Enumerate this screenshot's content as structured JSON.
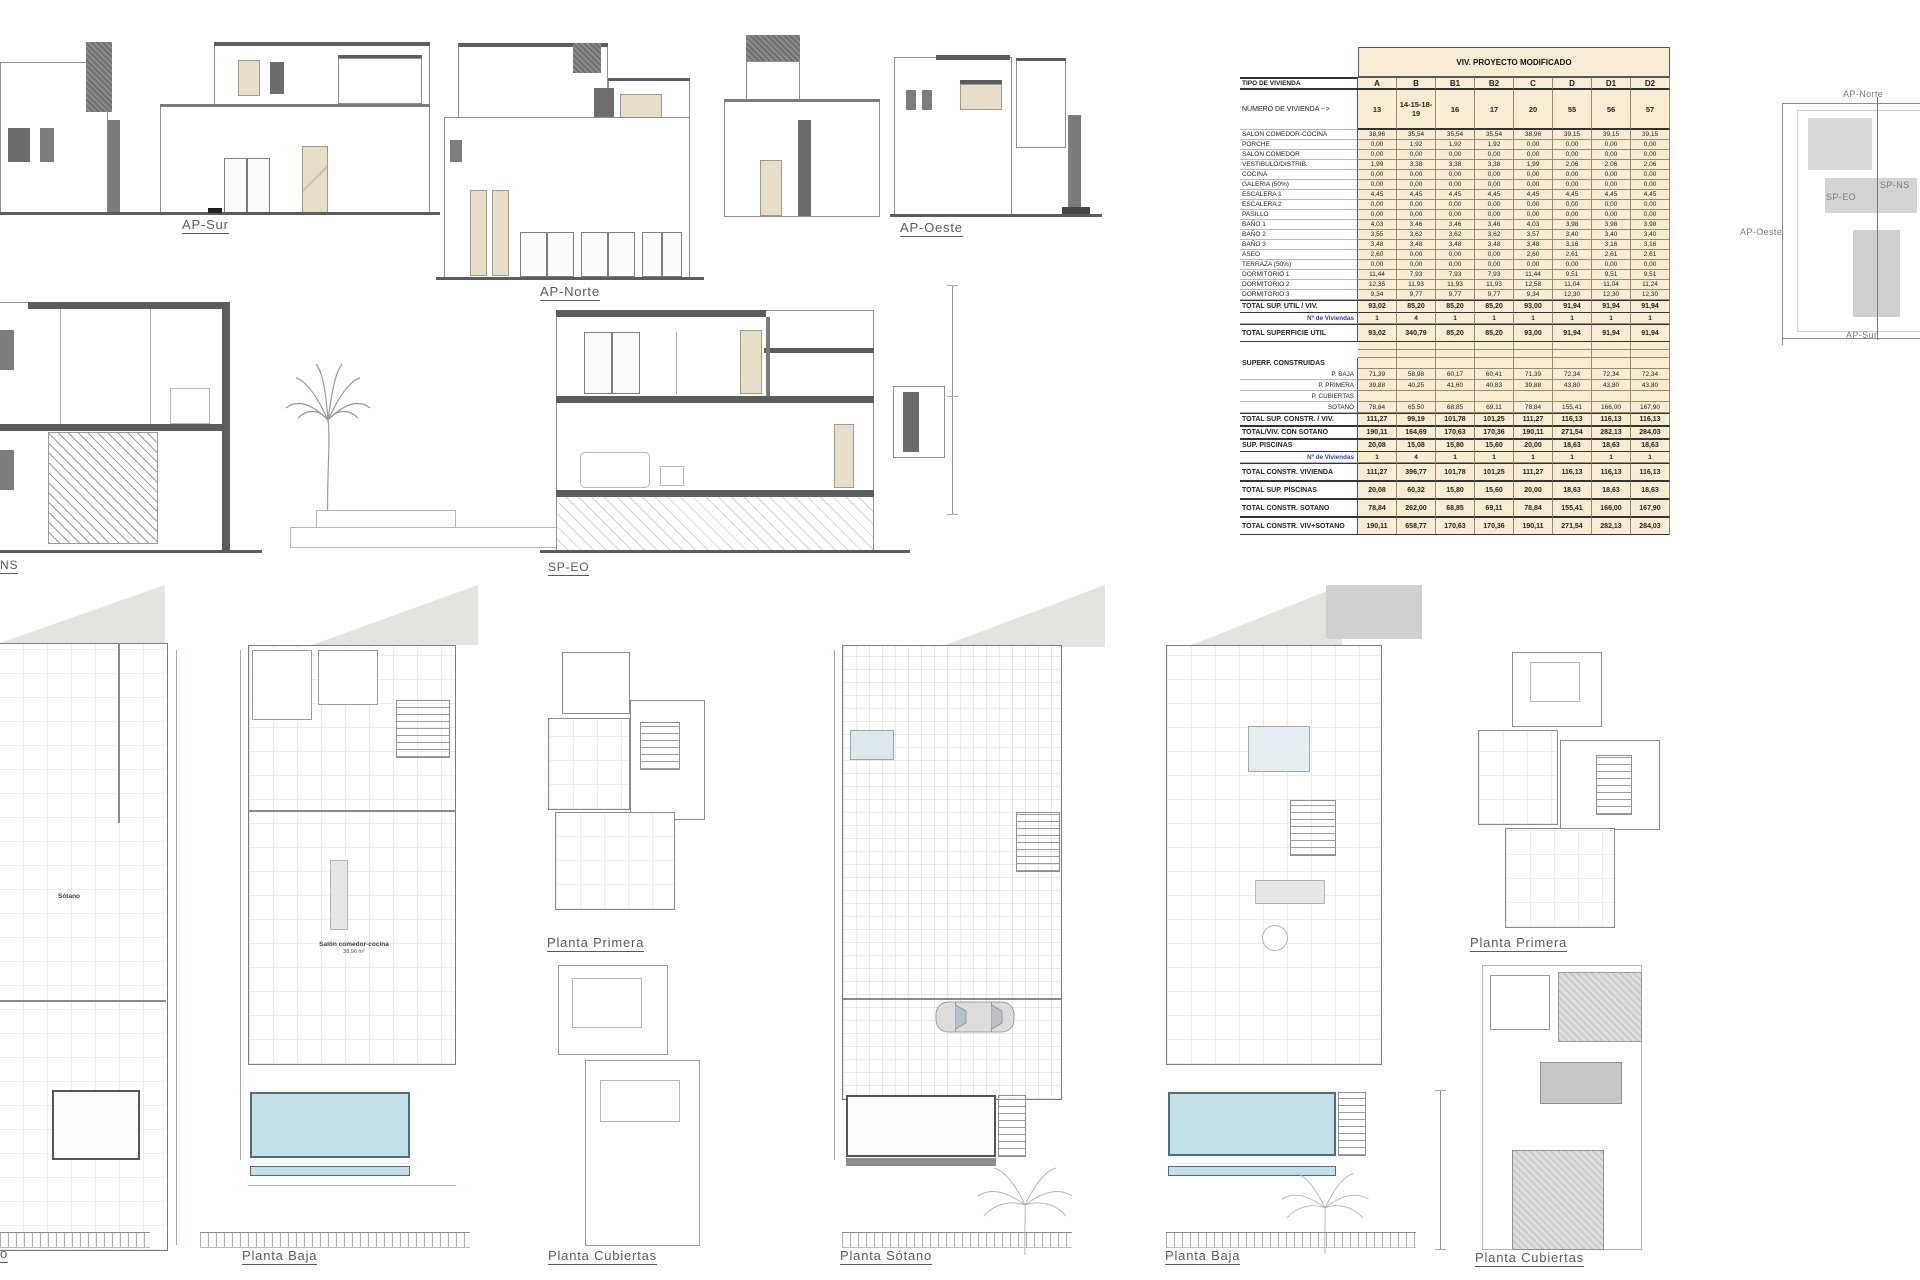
{
  "labels": {
    "ap_sur": "AP-Sur",
    "ap_norte": "AP-Norte",
    "ap_oeste": "AP-Oeste",
    "sp_eo": "SP-EO",
    "sp_ns_truncated": "NS"
  },
  "key_plan": {
    "north": "AP-Norte",
    "west": "AP-Oeste",
    "south": "AP-Sur",
    "sp_ns": "SP-NS",
    "sp_eo": "SP-EO"
  },
  "plans": {
    "col1": {
      "label_truncated": "o",
      "room_label": "Sótano"
    },
    "col2": {
      "label": "Planta Baja",
      "room_label": "Salón comedor-cocina",
      "room_area": "38,96 m²"
    },
    "col3_top": {
      "label": "Planta Primera"
    },
    "col3_bottom": {
      "label": "Planta Cubiertas"
    },
    "col4": {
      "label": "Planta Sótano"
    },
    "col5": {
      "label": "Planta Baja"
    },
    "col6_top": {
      "label": "Planta Primera"
    },
    "col6_bottom": {
      "label": "Planta Cubiertas"
    }
  },
  "table": {
    "title": "VIV. PROYECTO MODIFICADO",
    "tipo_label": "TIPO DE VIVIENDA",
    "numero_label": "NUMERO DE VIVIENDA -->",
    "types": [
      "A",
      "B",
      "B1",
      "B2",
      "C",
      "D",
      "D1",
      "D2"
    ],
    "numeros": [
      "13",
      "14-15-18-19",
      "16",
      "17",
      "20",
      "55",
      "56",
      "57"
    ],
    "rows": [
      {
        "s": "n",
        "label": "SALON COMEDOR-COCINA",
        "v": [
          "38,96",
          "35,54",
          "35,54",
          "35,54",
          "38,96",
          "39,15",
          "39,15",
          "39,15"
        ]
      },
      {
        "s": "n",
        "label": "PORCHE",
        "v": [
          "0,00",
          "1,92",
          "1,92",
          "1,92",
          "0,00",
          "0,00",
          "0,00",
          "0,00"
        ]
      },
      {
        "s": "n",
        "label": "SALON COMEDOR",
        "v": [
          "0,00",
          "0,00",
          "0,00",
          "0,00",
          "0,00",
          "0,00",
          "0,00",
          "0,00"
        ]
      },
      {
        "s": "n",
        "label": "VESTIBULO/DISTRIB.",
        "v": [
          "1,99",
          "3,38",
          "3,38",
          "3,38",
          "1,99",
          "2,06",
          "2,06",
          "2,06"
        ]
      },
      {
        "s": "n",
        "label": "COCINA",
        "v": [
          "0,00",
          "0,00",
          "0,00",
          "0,00",
          "0,00",
          "0,00",
          "0,00",
          "0,00"
        ]
      },
      {
        "s": "n",
        "label": "GALERIA (50%)",
        "v": [
          "0,00",
          "0,00",
          "0,00",
          "0,00",
          "0,00",
          "0,00",
          "0,00",
          "0,00"
        ]
      },
      {
        "s": "n",
        "label": "ESCALERA 1",
        "v": [
          "4,45",
          "4,45",
          "4,45",
          "4,45",
          "4,45",
          "4,45",
          "4,45",
          "4,45"
        ]
      },
      {
        "s": "n",
        "label": "ESCALERA 2",
        "v": [
          "0,00",
          "0,00",
          "0,00",
          "0,00",
          "0,00",
          "0,00",
          "0,00",
          "0,00"
        ]
      },
      {
        "s": "n",
        "label": "PASILLO",
        "v": [
          "0,00",
          "0,00",
          "0,00",
          "0,00",
          "0,00",
          "0,00",
          "0,00",
          "0,00"
        ]
      },
      {
        "s": "n",
        "label": "BAÑO 1",
        "v": [
          "4,03",
          "3,46",
          "3,46",
          "3,46",
          "4,03",
          "3,98",
          "3,98",
          "3,98"
        ]
      },
      {
        "s": "n",
        "label": "BAÑO 2",
        "v": [
          "3,55",
          "3,62",
          "3,62",
          "3,62",
          "3,57",
          "3,40",
          "3,40",
          "3,40"
        ]
      },
      {
        "s": "n",
        "label": "BAÑO 3",
        "v": [
          "3,48",
          "3,48",
          "3,48",
          "3,48",
          "3,48",
          "3,16",
          "3,16",
          "3,16"
        ]
      },
      {
        "s": "n",
        "label": "ASEO",
        "v": [
          "2,60",
          "0,00",
          "0,00",
          "0,00",
          "2,60",
          "2,61",
          "2,61",
          "2,61"
        ]
      },
      {
        "s": "n",
        "label": "TERRAZA (50%)",
        "v": [
          "0,00",
          "0,00",
          "0,00",
          "0,00",
          "0,00",
          "0,00",
          "0,00",
          "0,00"
        ]
      },
      {
        "s": "n",
        "label": "DORMITORIO 1",
        "v": [
          "11,44",
          "7,93",
          "7,93",
          "7,93",
          "11,44",
          "9,51",
          "9,51",
          "9,51"
        ]
      },
      {
        "s": "n",
        "label": "DORMITORIO 2",
        "v": [
          "12,35",
          "11,93",
          "11,93",
          "11,93",
          "12,58",
          "11,04",
          "11,04",
          "11,24"
        ]
      },
      {
        "s": "n",
        "label": "DORMITORIO 3",
        "v": [
          "9,34",
          "9,77",
          "9,77",
          "9,77",
          "9,34",
          "12,30",
          "12,30",
          "12,30"
        ]
      },
      {
        "s": "b",
        "label": "TOTAL SUP. UTIL / VIV.",
        "v": [
          "93,02",
          "85,20",
          "85,20",
          "85,20",
          "93,00",
          "91,94",
          "91,94",
          "91,94"
        ]
      },
      {
        "s": "u",
        "label": "Nº de Viviendas",
        "v": [
          "1",
          "4",
          "1",
          "1",
          "1",
          "1",
          "1",
          "1"
        ]
      },
      {
        "s": "bt",
        "label": "TOTAL SUPERFICIE UTIL",
        "v": [
          "93,02",
          "340,79",
          "85,20",
          "85,20",
          "93,00",
          "91,94",
          "91,94",
          "91,94"
        ]
      },
      {
        "s": "e",
        "label": "",
        "v": [
          "",
          "",
          "",
          "",
          "",
          "",
          "",
          ""
        ]
      },
      {
        "s": "e",
        "label": "",
        "v": [
          "",
          "",
          "",
          "",
          "",
          "",
          "",
          ""
        ]
      },
      {
        "s": "sec",
        "label": "SUPERF. CONSTRUIDAS",
        "v": [
          "",
          "",
          "",
          "",
          "",
          "",
          "",
          ""
        ]
      },
      {
        "s": "r",
        "label": "P. BAJA",
        "v": [
          "71,39",
          "58,98",
          "60,17",
          "60,41",
          "71,39",
          "72,34",
          "72,34",
          "72,34"
        ]
      },
      {
        "s": "r",
        "label": "P. PRIMERA",
        "v": [
          "39,88",
          "40,25",
          "41,60",
          "40,83",
          "39,88",
          "43,80",
          "43,80",
          "43,80"
        ]
      },
      {
        "s": "r",
        "label": "P. CUBIERTAS",
        "v": [
          "",
          "",
          "",
          "",
          "",
          "",
          "",
          ""
        ]
      },
      {
        "s": "r",
        "label": "SOTANO",
        "v": [
          "78,84",
          "65,50",
          "68,85",
          "69,11",
          "78,84",
          "155,41",
          "166,00",
          "167,90"
        ]
      },
      {
        "s": "b",
        "label": "TOTAL SUP. CONSTR. / VIV.",
        "v": [
          "111,27",
          "99,19",
          "101,78",
          "101,25",
          "111,27",
          "116,13",
          "116,13",
          "116,13"
        ]
      },
      {
        "s": "b",
        "label": "TOTAL/VIV. CON SOTANO",
        "v": [
          "190,11",
          "164,69",
          "170,63",
          "170,36",
          "190,11",
          "271,54",
          "282,13",
          "284,03"
        ]
      },
      {
        "s": "b",
        "label": "SUP. PISCINAS",
        "v": [
          "20,08",
          "15,08",
          "15,80",
          "15,60",
          "20,00",
          "18,63",
          "18,63",
          "18,63"
        ]
      },
      {
        "s": "u",
        "label": "Nº de Viviendas",
        "v": [
          "1",
          "4",
          "1",
          "1",
          "1",
          "1",
          "1",
          "1"
        ]
      },
      {
        "s": "bt",
        "label": "TOTAL CONSTR. VIVIENDA",
        "v": [
          "111,27",
          "396,77",
          "101,78",
          "101,25",
          "111,27",
          "116,13",
          "116,13",
          "116,13"
        ]
      },
      {
        "s": "bt",
        "label": "TOTAL SUP. PISCINAS",
        "v": [
          "20,08",
          "60,32",
          "15,80",
          "15,60",
          "20,00",
          "18,63",
          "18,63",
          "18,63"
        ]
      },
      {
        "s": "bt",
        "label": "TOTAL CONSTR. SOTANO",
        "v": [
          "78,84",
          "262,00",
          "68,85",
          "69,11",
          "78,84",
          "155,41",
          "166,00",
          "167,90"
        ]
      },
      {
        "s": "bt",
        "label": "TOTAL CONSTR. VIV+SOTANO",
        "v": [
          "190,11",
          "658,77",
          "170,63",
          "170,36",
          "190,11",
          "271,54",
          "282,13",
          "284,03"
        ]
      }
    ]
  },
  "colors": {
    "table_fill": "#f8ecd2",
    "pool_blue": "#c3e1e8",
    "wall_dark": "#5c5c5c",
    "beige_accent": "#e7ddc8",
    "nviv_blue": "#2244bb"
  }
}
